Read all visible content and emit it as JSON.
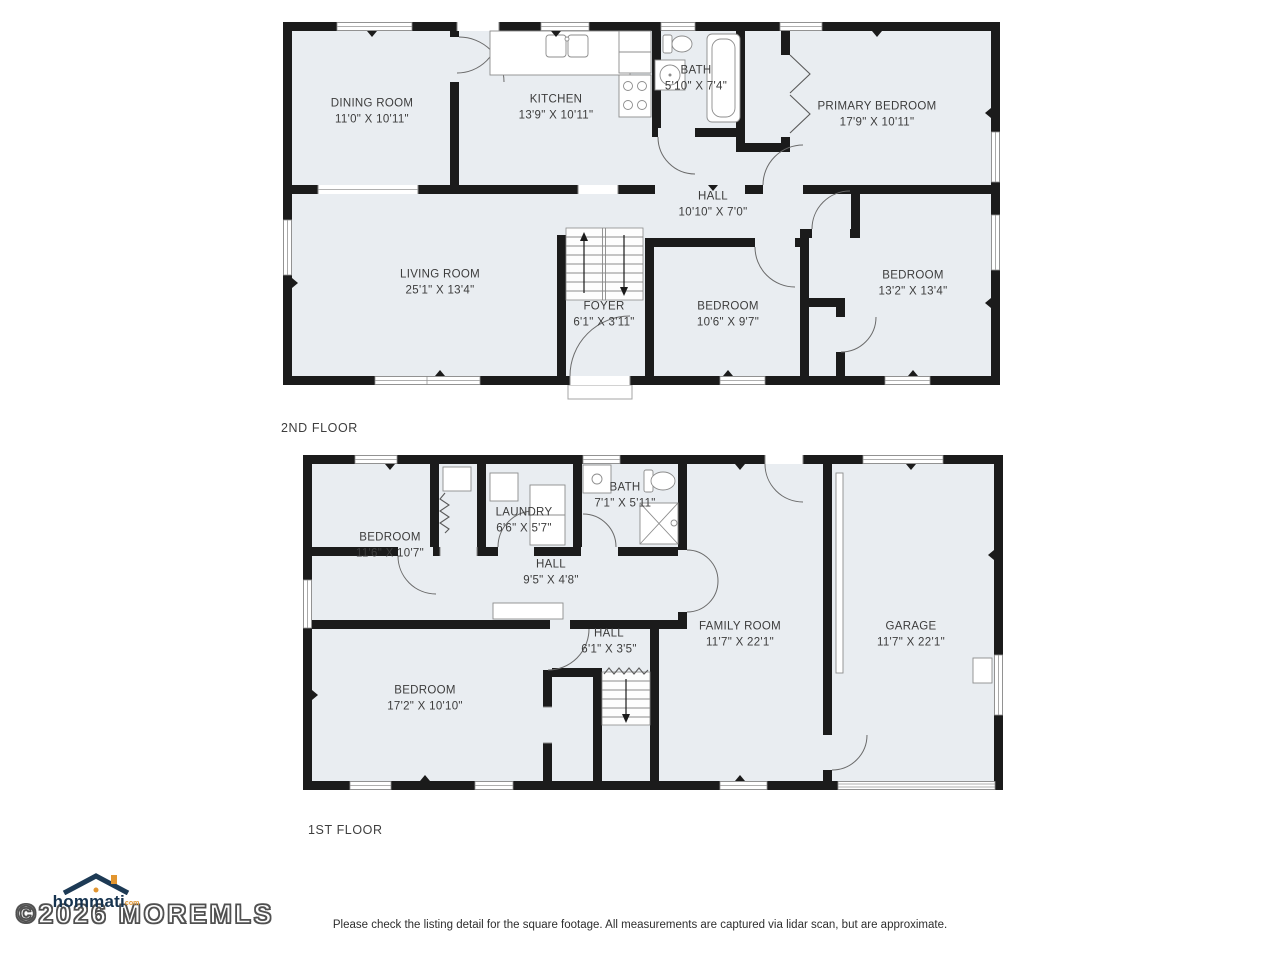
{
  "floors": {
    "second": {
      "label": "2ND FLOOR",
      "rooms": [
        {
          "name": "DINING ROOM",
          "dims": "11'0\" X 10'11\""
        },
        {
          "name": "KITCHEN",
          "dims": "13'9\" X 10'11\""
        },
        {
          "name": "BATH",
          "dims": "5'10\" X 7'4\""
        },
        {
          "name": "PRIMARY BEDROOM",
          "dims": "17'9\" X 10'11\""
        },
        {
          "name": "HALL",
          "dims": "10'10\" X 7'0\""
        },
        {
          "name": "LIVING ROOM",
          "dims": "25'1\" X 13'4\""
        },
        {
          "name": "FOYER",
          "dims": "6'1\" X 3'11\""
        },
        {
          "name": "BEDROOM",
          "dims": "10'6\" X 9'7\""
        },
        {
          "name": "BEDROOM",
          "dims": "13'2\" X 13'4\""
        }
      ]
    },
    "first": {
      "label": "1ST FLOOR",
      "rooms": [
        {
          "name": "BEDROOM",
          "dims": "11'6\" X 10'7\""
        },
        {
          "name": "LAUNDRY",
          "dims": "6'6\" X 5'7\""
        },
        {
          "name": "BATH",
          "dims": "7'1\" X 5'11\""
        },
        {
          "name": "HALL",
          "dims": "9'5\" X 4'8\""
        },
        {
          "name": "FAMILY ROOM",
          "dims": "11'7\" X 22'1\""
        },
        {
          "name": "GARAGE",
          "dims": "11'7\" X 22'1\""
        },
        {
          "name": "HALL",
          "dims": "6'1\" X 3'5\""
        },
        {
          "name": "BEDROOM",
          "dims": "17'2\" X 10'10\""
        }
      ]
    }
  },
  "footer": {
    "brand": "hommati",
    "brand_suffix": "com",
    "copyright": "©2026 MOREMLS",
    "disclaimer": "Please check the listing detail for the square footage. All measurements are captured via lidar scan, but are approximate."
  },
  "colors": {
    "wall": "#1b1b1b",
    "floor": "#e9edf1",
    "label_text": "#3c3c3c",
    "logo_navy": "#16334f",
    "logo_orange": "#e2952f"
  }
}
